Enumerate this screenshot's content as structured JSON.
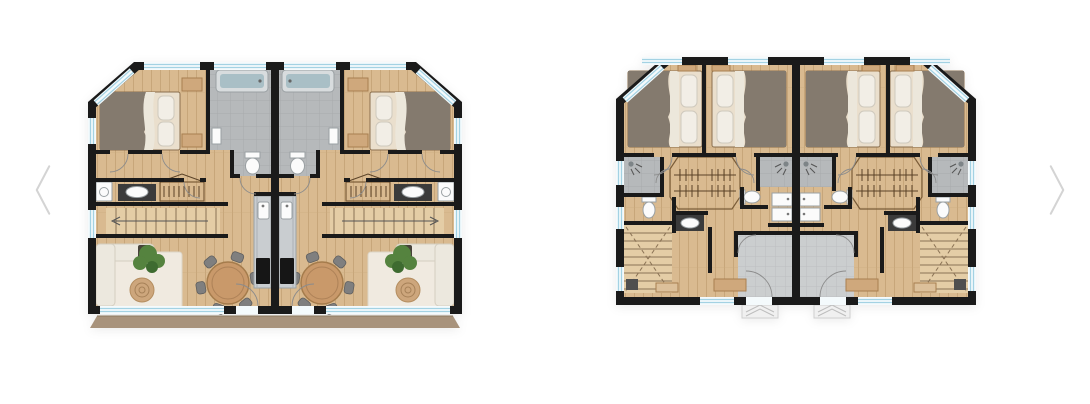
{
  "page": {
    "background": "#ffffff"
  },
  "carousel": {
    "prev_icon": "chevron-left",
    "next_icon": "chevron-right",
    "slide_count": 2,
    "slides": [
      {
        "name": "floor-plan-living-level"
      },
      {
        "name": "floor-plan-bedroom-level"
      }
    ]
  },
  "colors": {
    "wall": "#1a1a1a",
    "wood_floor": "#d9ba90",
    "wood_plank_line": "#c7a67a",
    "stair_wood": "#e4cda6",
    "tile": "#b6b9bb",
    "tile_grid": "#a8abad",
    "entry_tile": "#cbcecf",
    "entry_tile_grid": "#bcbfc1",
    "glass": "#f4fafc",
    "glass_line": "#a3d2e3",
    "balcony": "#a8937c",
    "sofa": "#ece8de",
    "rug": "#f0eae0",
    "jute": "#cda67c",
    "table": "#c9996a",
    "chair": "#7f7f7f",
    "plant": "#55833f",
    "plant_dark": "#3e6b30",
    "blanket": "#847a6e",
    "pillow": "#f2eee6",
    "tub": "#a9bfc6",
    "steel": "#c9cdd0",
    "cooktop": "#161616",
    "fixture": "#fbfbfb",
    "counter_dark": "#3b3b3b",
    "furniture_tan": "#cfa87c",
    "arrow": "#d4d4d4",
    "trim": "#8a6f4e"
  }
}
